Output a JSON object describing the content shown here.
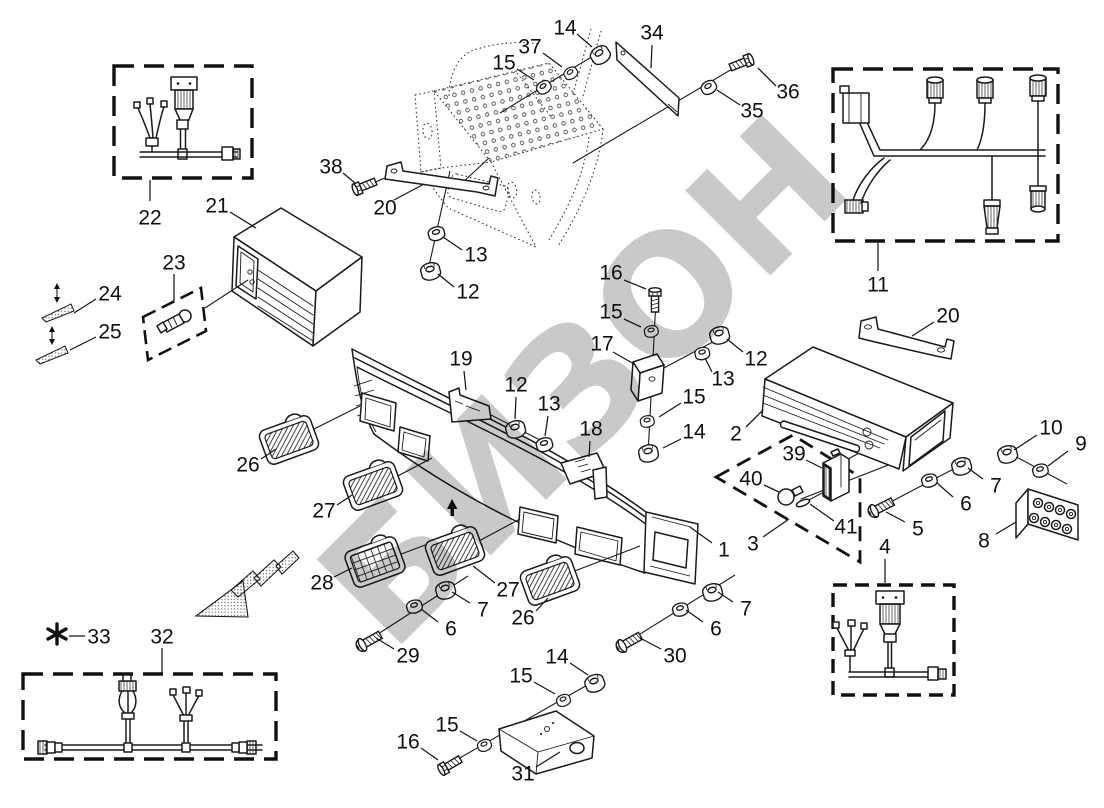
{
  "diagram": {
    "watermark": "БИЗОН",
    "accent_color": "#1a1a1a",
    "watermark_color": "#c0c0c0",
    "footnote_marker_label": "33",
    "callouts": [
      {
        "t": "22",
        "x": 150,
        "y": 218,
        "l": [
          150,
          201,
          150,
          180
        ]
      },
      {
        "t": "21",
        "x": 217,
        "y": 206,
        "l": [
          230,
          212,
          256,
          228
        ]
      },
      {
        "t": "23",
        "x": 174,
        "y": 263,
        "l": [
          174,
          274,
          174,
          301
        ]
      },
      {
        "t": "24",
        "x": 110,
        "y": 294,
        "l": [
          96,
          299,
          74,
          313
        ]
      },
      {
        "t": "25",
        "x": 110,
        "y": 332,
        "l": [
          96,
          337,
          70,
          350
        ]
      },
      {
        "t": "38",
        "x": 331,
        "y": 167,
        "l": [
          343,
          173,
          355,
          183
        ]
      },
      {
        "t": "20",
        "x": 385,
        "y": 208,
        "l": [
          394,
          200,
          424,
          184
        ]
      },
      {
        "t": "13",
        "x": 476,
        "y": 255,
        "l": [
          462,
          250,
          443,
          237
        ]
      },
      {
        "t": "12",
        "x": 468,
        "y": 292,
        "l": [
          454,
          287,
          438,
          274
        ]
      },
      {
        "t": "15",
        "x": 504,
        "y": 63,
        "l": [
          517,
          69,
          534,
          80
        ]
      },
      {
        "t": "37",
        "x": 530,
        "y": 47,
        "l": [
          543,
          53,
          562,
          67
        ]
      },
      {
        "t": "14",
        "x": 565,
        "y": 28,
        "l": [
          577,
          34,
          592,
          47
        ]
      },
      {
        "t": "34",
        "x": 652,
        "y": 33,
        "l": [
          652,
          45,
          651,
          68
        ]
      },
      {
        "t": "35",
        "x": 752,
        "y": 111,
        "l": [
          740,
          105,
          717,
          90
        ]
      },
      {
        "t": "36",
        "x": 788,
        "y": 92,
        "l": [
          776,
          86,
          758,
          68
        ]
      },
      {
        "t": "11",
        "x": 878,
        "y": 285,
        "l": [
          878,
          271,
          878,
          243
        ]
      },
      {
        "t": "16",
        "x": 611,
        "y": 273,
        "l": [
          624,
          280,
          646,
          289
        ]
      },
      {
        "t": "15",
        "x": 611,
        "y": 312,
        "l": [
          624,
          319,
          641,
          327
        ]
      },
      {
        "t": "17",
        "x": 602,
        "y": 344,
        "l": [
          613,
          352,
          634,
          364
        ]
      },
      {
        "t": "19",
        "x": 461,
        "y": 359,
        "l": [
          464,
          371,
          466,
          390
        ]
      },
      {
        "t": "12",
        "x": 516,
        "y": 385,
        "l": [
          516,
          397,
          515,
          419
        ]
      },
      {
        "t": "13",
        "x": 549,
        "y": 404,
        "l": [
          548,
          416,
          545,
          436
        ]
      },
      {
        "t": "18",
        "x": 591,
        "y": 429,
        "l": [
          590,
          441,
          589,
          457
        ]
      },
      {
        "t": "12",
        "x": 756,
        "y": 359,
        "l": [
          743,
          352,
          727,
          339
        ]
      },
      {
        "t": "13",
        "x": 723,
        "y": 379,
        "l": [
          712,
          372,
          705,
          358
        ]
      },
      {
        "t": "15",
        "x": 694,
        "y": 397,
        "l": [
          681,
          403,
          659,
          417
        ]
      },
      {
        "t": "14",
        "x": 694,
        "y": 432,
        "l": [
          681,
          439,
          663,
          448
        ]
      },
      {
        "t": "2",
        "x": 736,
        "y": 434,
        "l": [
          746,
          427,
          763,
          410
        ]
      },
      {
        "t": "20",
        "x": 948,
        "y": 316,
        "l": [
          934,
          322,
          912,
          336
        ]
      },
      {
        "t": "10",
        "x": 1051,
        "y": 428,
        "l": [
          1037,
          435,
          1014,
          450
        ]
      },
      {
        "t": "9",
        "x": 1081,
        "y": 444,
        "l": [
          1068,
          451,
          1048,
          466
        ]
      },
      {
        "t": "7",
        "x": 996,
        "y": 486,
        "l": [
          983,
          479,
          968,
          468
        ]
      },
      {
        "t": "6",
        "x": 966,
        "y": 504,
        "l": [
          953,
          497,
          937,
          483
        ]
      },
      {
        "t": "5",
        "x": 918,
        "y": 529,
        "l": [
          905,
          522,
          886,
          512
        ]
      },
      {
        "t": "8",
        "x": 984,
        "y": 541,
        "l": [
          996,
          534,
          1016,
          522
        ]
      },
      {
        "t": "39",
        "x": 794,
        "y": 454,
        "l": [
          806,
          460,
          822,
          468
        ]
      },
      {
        "t": "40",
        "x": 751,
        "y": 479,
        "l": [
          764,
          485,
          779,
          492
        ]
      },
      {
        "t": "41",
        "x": 846,
        "y": 527,
        "l": [
          834,
          521,
          810,
          504
        ]
      },
      {
        "t": "3",
        "x": 753,
        "y": 544,
        "l": [
          763,
          537,
          789,
          519
        ]
      },
      {
        "t": "1",
        "x": 724,
        "y": 550,
        "l": [
          712,
          543,
          690,
          527
        ]
      },
      {
        "t": "4",
        "x": 885,
        "y": 547,
        "l": [
          885,
          559,
          885,
          583
        ]
      },
      {
        "t": "26",
        "x": 248,
        "y": 465,
        "l": [
          261,
          459,
          276,
          449
        ]
      },
      {
        "t": "27",
        "x": 324,
        "y": 511,
        "l": [
          337,
          505,
          352,
          495
        ]
      },
      {
        "t": "28",
        "x": 322,
        "y": 583,
        "l": [
          334,
          577,
          352,
          568
        ]
      },
      {
        "t": "27",
        "x": 508,
        "y": 590,
        "l": [
          495,
          583,
          473,
          566
        ]
      },
      {
        "t": "26",
        "x": 523,
        "y": 618,
        "l": [
          536,
          611,
          548,
          598
        ]
      },
      {
        "t": "7",
        "x": 483,
        "y": 610,
        "l": [
          470,
          603,
          452,
          592
        ]
      },
      {
        "t": "6",
        "x": 451,
        "y": 629,
        "l": [
          438,
          622,
          421,
          609
        ]
      },
      {
        "t": "29",
        "x": 408,
        "y": 656,
        "l": [
          394,
          649,
          376,
          638
        ]
      },
      {
        "t": "30",
        "x": 675,
        "y": 656,
        "l": [
          661,
          649,
          640,
          638
        ]
      },
      {
        "t": "6",
        "x": 716,
        "y": 629,
        "l": [
          703,
          622,
          686,
          610
        ]
      },
      {
        "t": "7",
        "x": 746,
        "y": 609,
        "l": [
          733,
          602,
          718,
          592
        ]
      },
      {
        "t": "14",
        "x": 557,
        "y": 657,
        "l": [
          570,
          663,
          588,
          675
        ]
      },
      {
        "t": "15",
        "x": 521,
        "y": 676,
        "l": [
          534,
          682,
          555,
          694
        ]
      },
      {
        "t": "15",
        "x": 447,
        "y": 725,
        "l": [
          460,
          731,
          477,
          741
        ]
      },
      {
        "t": "16",
        "x": 408,
        "y": 742,
        "l": [
          421,
          748,
          438,
          760
        ]
      },
      {
        "t": "31",
        "x": 523,
        "y": 774,
        "l": [
          536,
          767,
          560,
          752
        ]
      },
      {
        "t": "33",
        "x": 99,
        "y": 637,
        "l": [
          85,
          636,
          69,
          636
        ]
      },
      {
        "t": "32",
        "x": 162,
        "y": 637,
        "l": [
          162,
          648,
          162,
          673
        ]
      }
    ]
  }
}
